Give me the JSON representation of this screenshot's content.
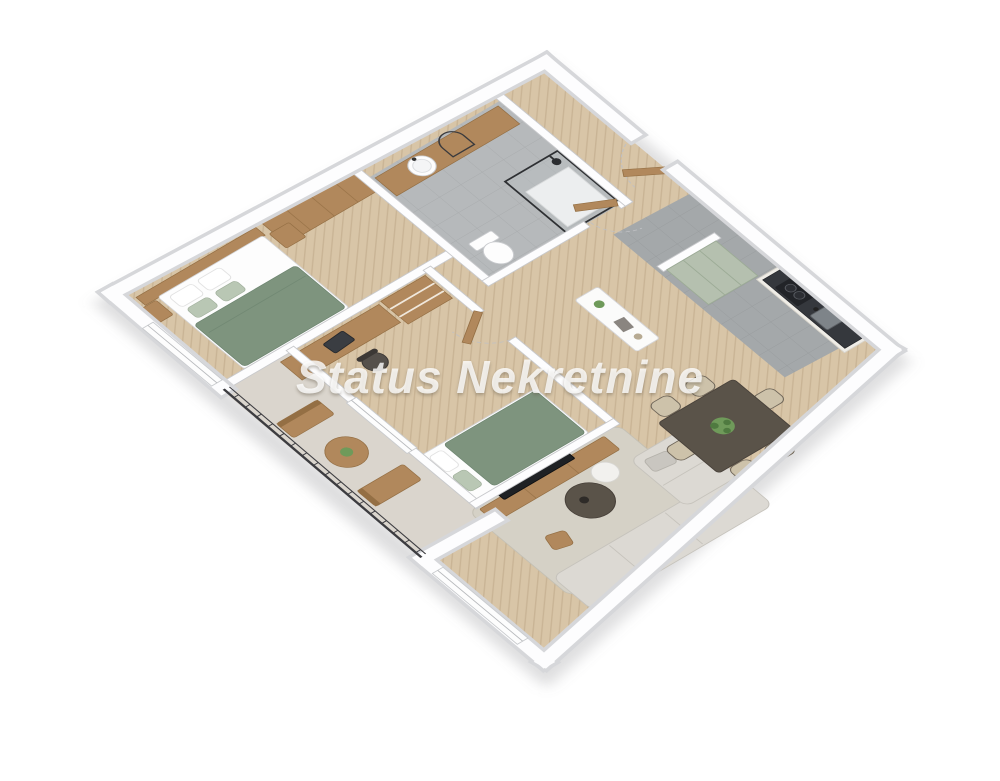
{
  "watermark": {
    "text": "Status Nekretnine"
  },
  "colors": {
    "bg": "#ffffff",
    "wallFill": "#fdfdfe",
    "wallEdge": "#c8c9cc",
    "wallCasing": "#d6d7da",
    "parquet": "#d8c5a7",
    "parquetLine": "rgba(141,111,74,0.20)",
    "tileFloor": "#b6b9bb",
    "tileLine": "rgba(70,72,78,0.12)",
    "kitchenFloor": "#a4a8aa",
    "balconyFloor": "#dad5cd",
    "wood": "#b1885c",
    "woodDark": "#946f44",
    "green": "#7e947e",
    "greenDark": "#6d8570",
    "pillowSage": "#b9c7b4",
    "sofa": "#dcd9d3",
    "sofaLine": "#c6c3bc",
    "rug": "#d5d1c6",
    "tableDark": "#5a5349",
    "chairBeige": "#cdc2aa",
    "chairDark": "#6e6558",
    "railing": "#3c3c40",
    "sage": "#b5c0af",
    "counter": "#35383d",
    "cream": "#efede7",
    "plant": "#6f9a5a",
    "plantDark": "#4f7a40",
    "watermark": "rgba(255,255,255,0.80)",
    "shadow": "rgba(123,123,128,0.25)"
  },
  "scene": {
    "type": "3d-floor-plan",
    "projection": "axonometric",
    "rooms": [
      "bedroom-1",
      "bathroom",
      "entry-hall",
      "kitchen",
      "dining-area",
      "living-room",
      "bedroom-2",
      "balcony"
    ],
    "furniture": [
      "double-bed",
      "wardrobe",
      "nightstands",
      "vanity-sink",
      "mirror",
      "shower",
      "toilet",
      "entry-door",
      "sideboard",
      "sage-cabinets",
      "kitchen-counter",
      "cooktop",
      "kitchen-sink",
      "dining-table",
      "dining-chairs",
      "table-plant",
      "corner-sofa",
      "coffee-table",
      "side-table",
      "wood-stool",
      "area-rug",
      "tv-console",
      "tv",
      "desk",
      "office-chair",
      "shelf-unit",
      "single-bed",
      "balcony-table",
      "balcony-benches",
      "railing"
    ]
  }
}
